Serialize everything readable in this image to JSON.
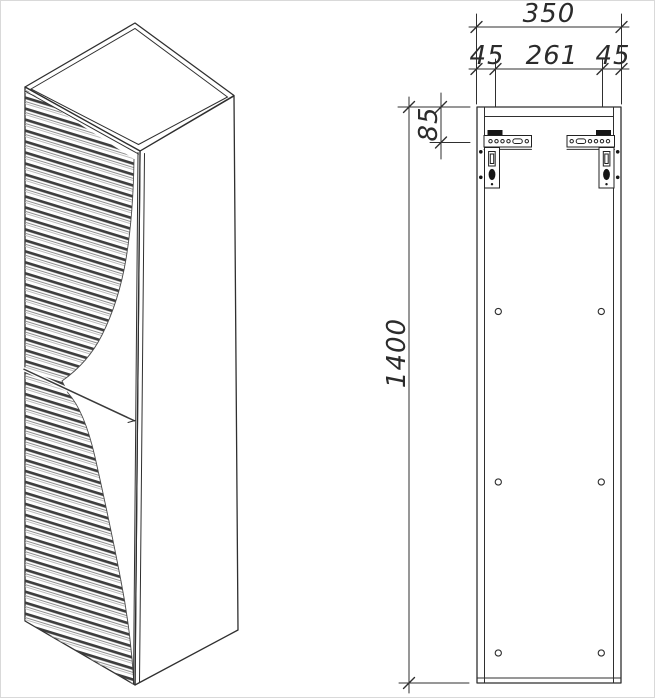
{
  "drawing": {
    "type": "furniture technical drawing",
    "subject": "tall wall-mounted louvered cabinet",
    "views": {
      "isometric": "cabinet isometric view with louvered doors",
      "rear": "rear elevation with mounting brackets and fixing holes"
    },
    "colors": {
      "background": "#ffffff",
      "line": "#2f2f2f",
      "slat_dark": "#3d3d3d",
      "slat_mid": "#909090",
      "slat_light": "#b8b8b8",
      "bracket_fill": "#161616"
    },
    "dimensions": {
      "total_width": "350",
      "left_offset": "45",
      "center_span": "261",
      "right_offset": "45",
      "top_offset": "85",
      "height": "1400"
    },
    "features": {
      "mounting_brackets": 2,
      "fixing_hole_pairs": 3
    }
  }
}
